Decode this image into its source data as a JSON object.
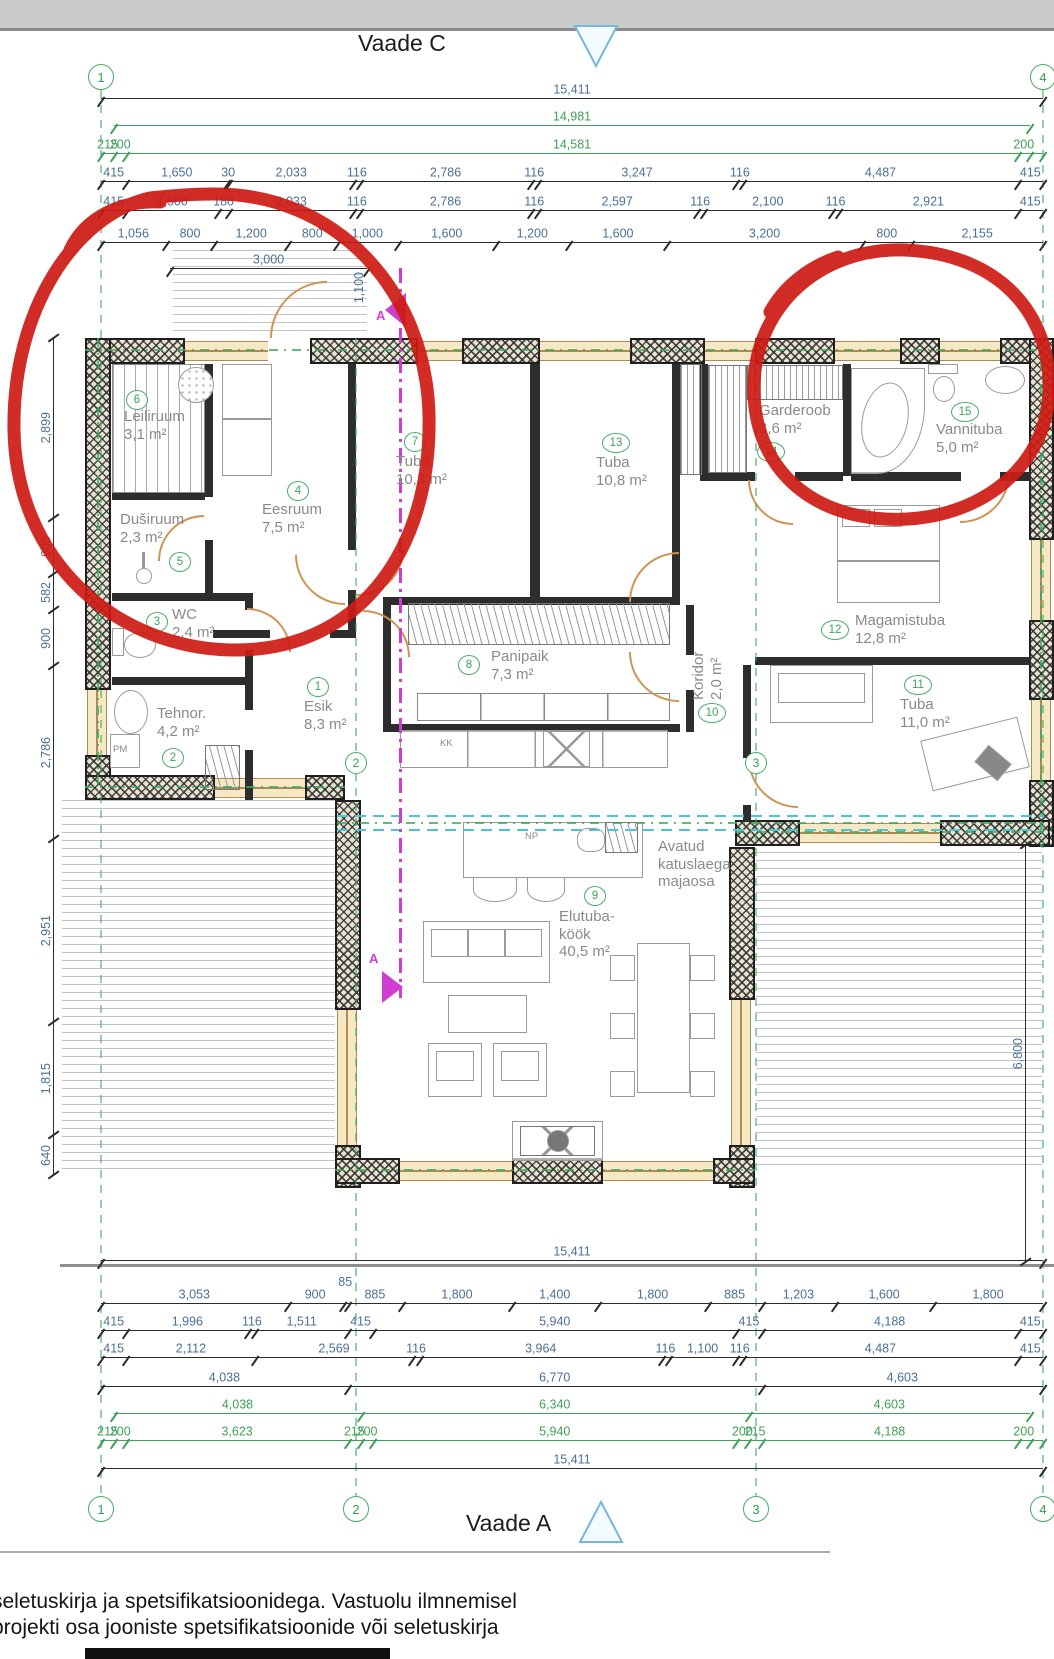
{
  "titles": {
    "top": "Vaade C",
    "bottom": "Vaade A"
  },
  "footer": {
    "line1": "seletuskirja ja spetsifikatsioonidega. Vastuolu ilmnemisel",
    "line2": "projekti osa  jooniste spetsifikatsioonide või seletuskirja"
  },
  "colors": {
    "dim_blue": "#4a7096",
    "dim_green": "#3fa057",
    "room_green": "#46ae63",
    "door_tan": "#cf9455",
    "magenta": "#cf3ecf",
    "cyan": "#47c6d8",
    "red_annotation": "#cd1a12"
  },
  "grid": {
    "columns": [
      {
        "label": "1",
        "x": 101
      },
      {
        "label": "2",
        "x": 356
      },
      {
        "label": "3",
        "x": 756
      },
      {
        "label": "4",
        "x": 1043
      }
    ]
  },
  "dim_rows_top": [
    {
      "y": 98,
      "x1": 101,
      "x2": 1043,
      "color": "blue",
      "segments": [
        {
          "v": "15,411",
          "w": 15411
        }
      ]
    },
    {
      "y": 125,
      "x1": 114,
      "x2": 1030,
      "color": "green",
      "segments": [
        {
          "v": "14,981",
          "w": 14981
        }
      ]
    },
    {
      "y": 153,
      "x1": 101,
      "x2": 1043,
      "color": "green",
      "segments": [
        {
          "v": "215",
          "w": 215
        },
        {
          "v": "200",
          "w": 200
        },
        {
          "v": "14,581",
          "w": 14581
        },
        {
          "v": "200",
          "w": 200
        },
        {
          "v": "",
          "w": 215
        }
      ]
    },
    {
      "y": 181,
      "x1": 101,
      "x2": 1043,
      "color": "blue",
      "segments": [
        {
          "v": "415",
          "w": 415
        },
        {
          "v": "1,650",
          "w": 1650
        },
        {
          "v": "30",
          "w": 30
        },
        {
          "v": "2,033",
          "w": 2033
        },
        {
          "v": "116",
          "w": 116
        },
        {
          "v": "2,786",
          "w": 2786
        },
        {
          "v": "116",
          "w": 116
        },
        {
          "v": "3,247",
          "w": 3247
        },
        {
          "v": "116",
          "w": 116
        },
        {
          "v": "4,487",
          "w": 4487
        },
        {
          "v": "415",
          "w": 415
        }
      ]
    },
    {
      "y": 210,
      "x1": 101,
      "x2": 1043,
      "color": "blue",
      "segments": [
        {
          "v": "415",
          "w": 415
        },
        {
          "v": "1,500",
          "w": 1500
        },
        {
          "v": "180",
          "w": 180
        },
        {
          "v": "2,033",
          "w": 2033
        },
        {
          "v": "116",
          "w": 116
        },
        {
          "v": "2,786",
          "w": 2786
        },
        {
          "v": "116",
          "w": 116
        },
        {
          "v": "2,597",
          "w": 2597
        },
        {
          "v": "116",
          "w": 116
        },
        {
          "v": "2,100",
          "w": 2100
        },
        {
          "v": "116",
          "w": 116
        },
        {
          "v": "2,921",
          "w": 2921
        },
        {
          "v": "415",
          "w": 415
        }
      ]
    },
    {
      "y": 242,
      "x1": 101,
      "x2": 1043,
      "color": "blue",
      "segments": [
        {
          "v": "1,056",
          "w": 1056
        },
        {
          "v": "800",
          "w": 800
        },
        {
          "v": "1,200",
          "w": 1200
        },
        {
          "v": "800",
          "w": 800
        },
        {
          "v": "1,000",
          "w": 1000
        },
        {
          "v": "1,600",
          "w": 1600
        },
        {
          "v": "1,200",
          "w": 1200
        },
        {
          "v": "1,600",
          "w": 1600
        },
        {
          "v": "3,200",
          "w": 3200
        },
        {
          "v": "800",
          "w": 800
        },
        {
          "v": "2,155",
          "w": 2155
        }
      ]
    },
    {
      "y": 268,
      "x1": 170,
      "x2": 367,
      "color": "blue",
      "segments": [
        {
          "v": "3,000",
          "w": 3000
        }
      ]
    }
  ],
  "dim_rows_bottom": [
    {
      "y": 1260,
      "x1": 101,
      "x2": 1043,
      "color": "blue",
      "segments": [
        {
          "v": "15,411",
          "w": 15411
        }
      ]
    },
    {
      "y": 1303,
      "x1": 101,
      "x2": 1043,
      "color": "blue",
      "segments": [
        {
          "v": "3,053",
          "w": 3053
        },
        {
          "v": "900",
          "w": 900
        },
        {
          "v": "85",
          "w": 85,
          "raise": true
        },
        {
          "v": "885",
          "w": 885
        },
        {
          "v": "1,800",
          "w": 1800
        },
        {
          "v": "1,400",
          "w": 1400
        },
        {
          "v": "1,800",
          "w": 1800
        },
        {
          "v": "885",
          "w": 885
        },
        {
          "v": "1,203",
          "w": 1203
        },
        {
          "v": "1,600",
          "w": 1600
        },
        {
          "v": "1,800",
          "w": 1800
        }
      ]
    },
    {
      "y": 1330,
      "x1": 101,
      "x2": 1043,
      "color": "blue",
      "segments": [
        {
          "v": "415",
          "w": 415
        },
        {
          "v": "1,996",
          "w": 1996
        },
        {
          "v": "116",
          "w": 116
        },
        {
          "v": "1,511",
          "w": 1511
        },
        {
          "v": "415",
          "w": 415
        },
        {
          "v": "5,940",
          "w": 5940
        },
        {
          "v": "415",
          "w": 415
        },
        {
          "v": "4,188",
          "w": 4188
        },
        {
          "v": "415",
          "w": 415
        }
      ]
    },
    {
      "y": 1357,
      "x1": 101,
      "x2": 1043,
      "color": "blue",
      "segments": [
        {
          "v": "415",
          "w": 415
        },
        {
          "v": "2,112",
          "w": 2112
        },
        {
          "v": "2,569",
          "w": 2569
        },
        {
          "v": "116",
          "w": 116
        },
        {
          "v": "3,964",
          "w": 3964
        },
        {
          "v": "116",
          "w": 116
        },
        {
          "v": "1,100",
          "w": 1100
        },
        {
          "v": "116",
          "w": 116
        },
        {
          "v": "4,487",
          "w": 4487
        },
        {
          "v": "415",
          "w": 416
        }
      ]
    },
    {
      "y": 1386,
      "x1": 101,
      "x2": 1043,
      "color": "blue",
      "segments": [
        {
          "v": "4,038",
          "w": 4038
        },
        {
          "v": "6,770",
          "w": 6770
        },
        {
          "v": "4,603",
          "w": 4603
        }
      ]
    },
    {
      "y": 1413,
      "x1": 114,
      "x2": 1030,
      "color": "green",
      "segments": [
        {
          "v": "4,038",
          "w": 4038
        },
        {
          "v": "6,340",
          "w": 6340
        },
        {
          "v": "4,603",
          "w": 4603
        }
      ]
    },
    {
      "y": 1440,
      "x1": 101,
      "x2": 1043,
      "color": "green",
      "segments": [
        {
          "v": "215",
          "w": 215
        },
        {
          "v": "200",
          "w": 200
        },
        {
          "v": "3,623",
          "w": 3623
        },
        {
          "v": "215",
          "w": 215
        },
        {
          "v": "200",
          "w": 200
        },
        {
          "v": "5,940",
          "w": 5940
        },
        {
          "v": "200",
          "w": 200
        },
        {
          "v": "215",
          "w": 215
        },
        {
          "v": "4,188",
          "w": 4188
        },
        {
          "v": "200",
          "w": 200
        },
        {
          "v": "",
          "w": 215
        }
      ]
    },
    {
      "y": 1468,
      "x1": 101,
      "x2": 1043,
      "color": "blue",
      "segments": [
        {
          "v": "15,411",
          "w": 15411
        }
      ]
    }
  ],
  "dim_left": {
    "x": 53,
    "y1": 338,
    "y2": 1175,
    "segments": [
      {
        "v": "2,899",
        "w": 2899
      },
      {
        "v": "900",
        "w": 900
      },
      {
        "v": "582",
        "w": 582
      },
      {
        "v": "900",
        "w": 900
      },
      {
        "v": "2,786",
        "w": 2786
      },
      {
        "v": "2,951",
        "w": 2951
      },
      {
        "v": "1,815",
        "w": 1815
      },
      {
        "v": "640",
        "w": 640
      }
    ]
  },
  "dim_right": {
    "x": 1025,
    "y1": 845,
    "y2": 1262,
    "segments": [
      {
        "v": "6,800",
        "w": 6800
      }
    ]
  },
  "rooms": [
    {
      "num": "6",
      "cx": 136,
      "cy": 399,
      "tx": 124,
      "ty": 408,
      "lines": [
        "Leiliruum",
        "3,1 m²"
      ]
    },
    {
      "num": "5",
      "cx": 179,
      "cy": 561,
      "tx": 120,
      "ty": 511,
      "lines": [
        "Duširuum",
        "2,3 m²"
      ]
    },
    {
      "num": "3",
      "cx": 156,
      "cy": 621,
      "tx": 172,
      "ty": 606,
      "lines": [
        "WC",
        "2,4 m²"
      ]
    },
    {
      "num": "2",
      "cx": 172,
      "cy": 757,
      "tx": 157,
      "ty": 705,
      "lines": [
        "Tehnor.",
        "4,2 m²"
      ]
    },
    {
      "num": "1",
      "cx": 317,
      "cy": 686,
      "tx": 304,
      "ty": 698,
      "lines": [
        "Esik",
        "8,3 m²"
      ]
    },
    {
      "num": "4",
      "cx": 297,
      "cy": 490,
      "tx": 262,
      "ty": 501,
      "lines": [
        "Eesruum",
        "7,5 m²"
      ]
    },
    {
      "num": "7",
      "cx": 414,
      "cy": 441,
      "tx": 396,
      "ty": 453,
      "lines": [
        "Tuba",
        "10,3 m²"
      ]
    },
    {
      "num": "13",
      "cx": 615,
      "cy": 442,
      "tx": 596,
      "ty": 454,
      "lines": [
        "Tuba",
        "10,8 m²"
      ]
    },
    {
      "num": "8",
      "cx": 468,
      "cy": 664,
      "tx": 491,
      "ty": 648,
      "lines": [
        "Panipaik",
        "7,3 m²"
      ]
    },
    {
      "num": "10",
      "cx": 711,
      "cy": 712,
      "tx": 690,
      "ty": 700,
      "lines": [
        "Koridor",
        "2,0 m²"
      ],
      "vertical": true
    },
    {
      "num": "14",
      "cx": 770,
      "cy": 451,
      "tx": 759,
      "ty": 402,
      "lines": [
        "Garderoob",
        "3,6 m²"
      ]
    },
    {
      "num": "15",
      "cx": 964,
      "cy": 411,
      "tx": 936,
      "ty": 421,
      "lines": [
        "Vannituba",
        "5,0 m²"
      ]
    },
    {
      "num": "12",
      "cx": 834,
      "cy": 629,
      "tx": 855,
      "ty": 612,
      "lines": [
        "Magamistuba",
        "12,8 m²"
      ]
    },
    {
      "num": "11",
      "cx": 917,
      "cy": 684,
      "tx": 900,
      "ty": 696,
      "lines": [
        "Tuba",
        "11,0 m²"
      ]
    },
    {
      "num": "9",
      "cx": 594,
      "cy": 895,
      "tx": 559,
      "ty": 908,
      "lines": [
        "Elutuba-",
        "köök",
        "40,5 m²"
      ]
    }
  ],
  "annotations": {
    "open_roof": [
      "Avatud",
      "katuslaega",
      "majaosa"
    ],
    "np": "NP",
    "kk": "KK",
    "pm": "PM",
    "section_a_top": "A",
    "section_a_mid": "A",
    "dim_1100": "1,100"
  }
}
